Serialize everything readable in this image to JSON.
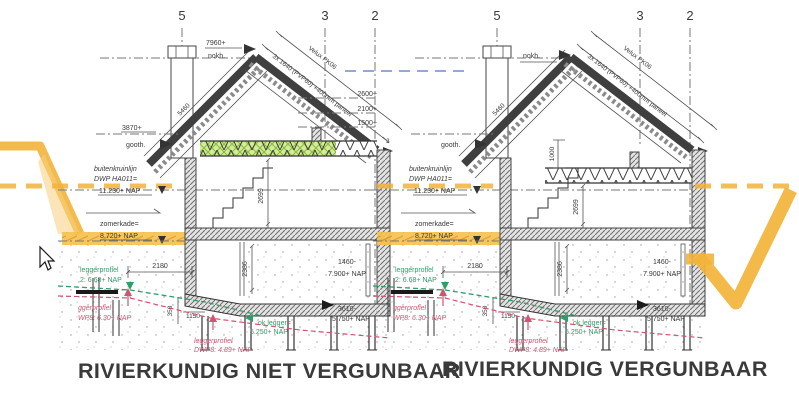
{
  "captions": {
    "left": "RIVIERKUNDIG NIET VERGUNBAAR",
    "right": "RIVIERKUNDIG VERGUNBAAR"
  },
  "grid_labels": {
    "g5": "5",
    "g3": "3",
    "g2": "2"
  },
  "roof": {
    "nok_value": "7960+",
    "nok_label": "nokh.",
    "goot_value": "3870+",
    "goot_label": "gooth.",
    "slope_length": "5460",
    "panel_note": "3x 1640 (PVP60) +400mm paneel",
    "velux_note": "Velux PK06",
    "mini_label": "3",
    "attic_drop_dim": "1000",
    "level_2600": "2600+",
    "level_2100": "2100+",
    "level_1500": "1500+"
  },
  "levels": {
    "buitenkruinlijn_line1": "buitenkruinlijn",
    "buitenkruinlijn_line2": "DWP HA011=",
    "buitenkruinlijn_value": "11.230+ NAP",
    "zomerkade_label": "zomerkade=",
    "zomerkade_value": "8.720+ NAP"
  },
  "dimensions": {
    "upper_storey": "2699",
    "lower_storey": "2386",
    "offset_2180": "2180",
    "offset_350": "350",
    "offset_1150": "1150",
    "floor_depth": "1460-",
    "floor_nap": "7.900+ NAP",
    "pile_depth": "3610-",
    "pile_nap": "5.750+ NAP"
  },
  "profiles": {
    "legger_green_label": "leggerprofiel",
    "legger_green_value": "2: 6.68+ NAP",
    "legger_red_label": "ggerprofiel",
    "legger_red_value": "WP8: 6.30+ NAP",
    "ok_legger_label": "ok legger=",
    "ok_legger_value": "5.250+ NAP",
    "legger_red2_label": "leggerprofiel",
    "legger_red2_value": "DWP8: 4.89+ NAP"
  },
  "colors": {
    "dike_orange": "#f2b33a",
    "profile_red": "#cf5572",
    "profile_green": "#2f9e68",
    "highlight_green": "#d3ec95",
    "caption_gray": "#3a3a3a",
    "waterline_blue": "#6f8fc9"
  }
}
